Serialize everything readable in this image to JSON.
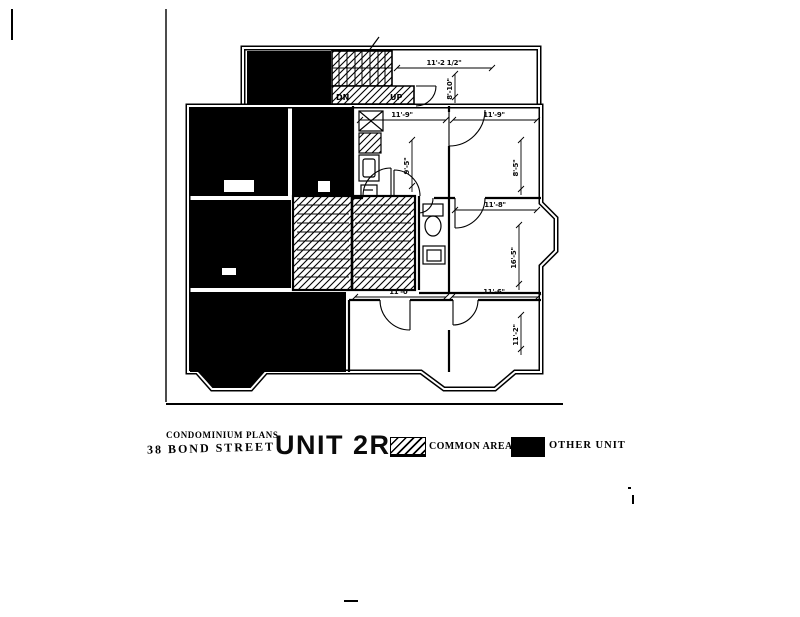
{
  "doc": {
    "plans_label": "CONDOMINIUM PLANS",
    "address": "38 BOND STREET",
    "unit_title": "UNIT 2R"
  },
  "legend": {
    "common_label": "COMMON AREAS",
    "other_label": "OTHER UNIT"
  },
  "plan": {
    "dims": [
      "11'-2 1/2\"",
      "8'-10\"",
      "11'-9\"",
      "11'-9\"",
      "9'-5\"",
      "8'-5\"",
      "11'-8\"",
      "16'-5\"",
      "11'-0\"",
      "11'-6\"",
      "11'-2\""
    ],
    "stair": {
      "down_label": "DN",
      "up_label": "UP"
    }
  },
  "colors": {
    "ink": "#000000",
    "paper": "#ffffff"
  }
}
